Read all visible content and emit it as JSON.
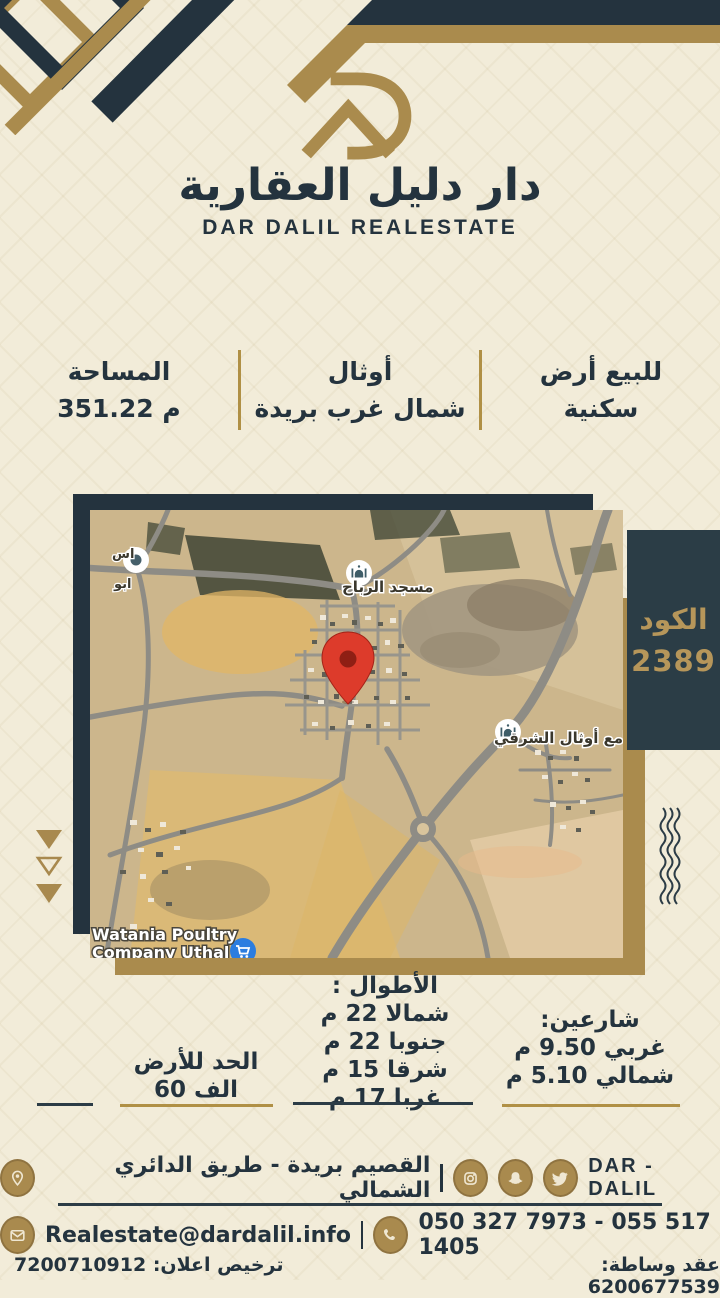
{
  "brand": {
    "title_ar": "دار دليل العقارية",
    "title_en": "DAR DALIL REALESTATE",
    "monogram_icon": "dar-dalil-d-roof-monogram"
  },
  "info_bar": {
    "listing_line1": "للبيع أرض",
    "listing_line2": "سكنية",
    "location_line1": "أوثال",
    "location_line2": "شمال غرب بريدة",
    "area_label": "المساحة",
    "area_value": "351.22 م"
  },
  "code_badge": {
    "label": "الكود",
    "value": "2389"
  },
  "map": {
    "label_mosque_north": "مسجد الرباح",
    "label_mosque_east": "جامع أوثال الشرقي",
    "label_poultry_1": "Watania Poultry",
    "label_poultry_2": "Company Uthal",
    "label_edge_1": "اس",
    "label_edge_2": "ابو",
    "icons": {
      "pin": "red-location-pin-icon",
      "mosque": "mosque-poi-icon",
      "cart": "shopping-cart-poi-icon",
      "dot": "generic-poi-icon"
    }
  },
  "details": {
    "lengths_title": "الأطوال :",
    "lengths": [
      "شمالا 22 م",
      "جنوبا 22 م",
      "شرقا 15 م",
      "غربا 17 م"
    ],
    "streets_title": "شارعين:",
    "streets": [
      "غربي 9.50 م",
      "شمالي 5.10 م"
    ],
    "price_label": "الحد للأرض",
    "price_value": "60 الف"
  },
  "footer": {
    "brand_name": "DAR - DALIL",
    "address": "القصيم بريدة - طريق الدائري الشمالي",
    "email": "Realestate@dardalil.info",
    "phones": "050 327 7973 - 055 517 1405",
    "license_contract": "عقد وساطة: 6200677539",
    "license_ad": "ترخيص اعلان: 7200710912",
    "icons": [
      "location-pin-icon",
      "instagram-icon",
      "snapchat-icon",
      "twitter-icon",
      "envelope-icon",
      "phone-icon"
    ]
  },
  "colors": {
    "navy": "#24333e",
    "gold": "#aa8b4d",
    "cream": "#f2ecd9",
    "pin_red": "#dd3b2b"
  }
}
